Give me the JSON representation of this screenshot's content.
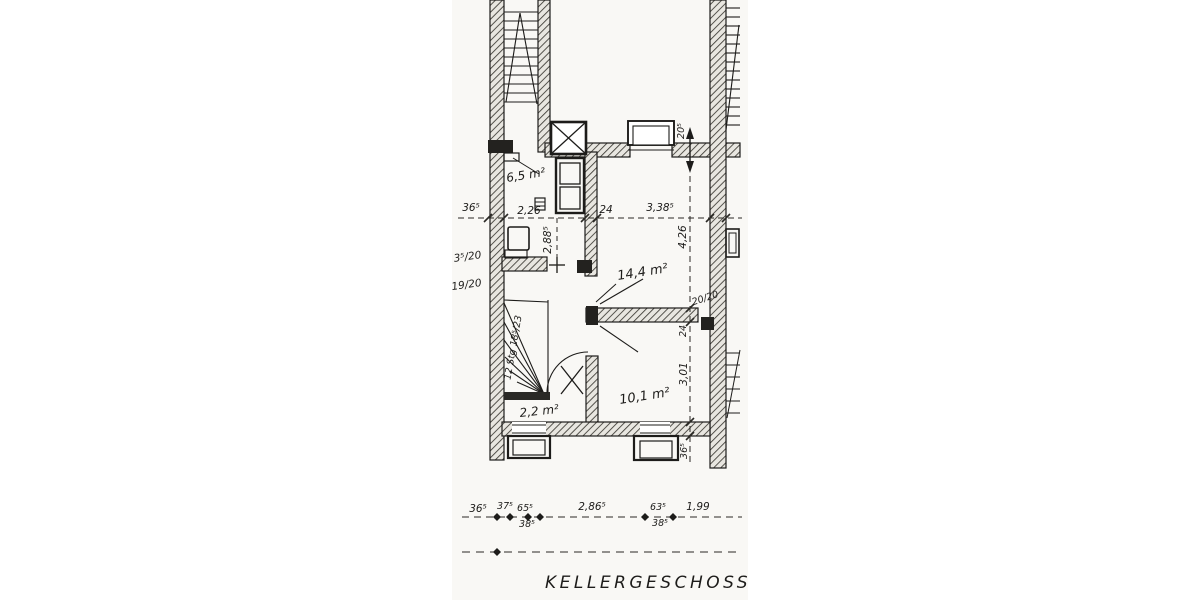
{
  "title": "KELLERGESCHOSS",
  "rooms": {
    "hall": "6,5 m²",
    "main": "14,4 m²",
    "back": "10,1 m²",
    "under_stair": "2,2 m²"
  },
  "stair_note": "12 Stg 18⁵/23",
  "dims": {
    "hall_width": "2,26",
    "wall_24": "24",
    "room_width": "3,38⁵",
    "hall_depth": "2,88⁵",
    "room_depth": "4,26",
    "pier": "20/20",
    "wall_24_v": "24",
    "back_depth": "3,01",
    "sill_36": "36⁵",
    "lintel_20": "20⁵",
    "left_36": "36⁵",
    "left_fraction_a": "3⁵/20",
    "left_fraction_b": "19/20"
  },
  "bottom_chain": {
    "c1": "36⁵",
    "c2": "37⁵",
    "c3": "65⁵",
    "c4": "38⁵",
    "c5": "2,86⁵",
    "c6": "63⁵",
    "c7": "38⁵",
    "c8": "1,99"
  },
  "colors": {
    "ink": "#1d1c1a",
    "paper": "#f7f6f2"
  }
}
